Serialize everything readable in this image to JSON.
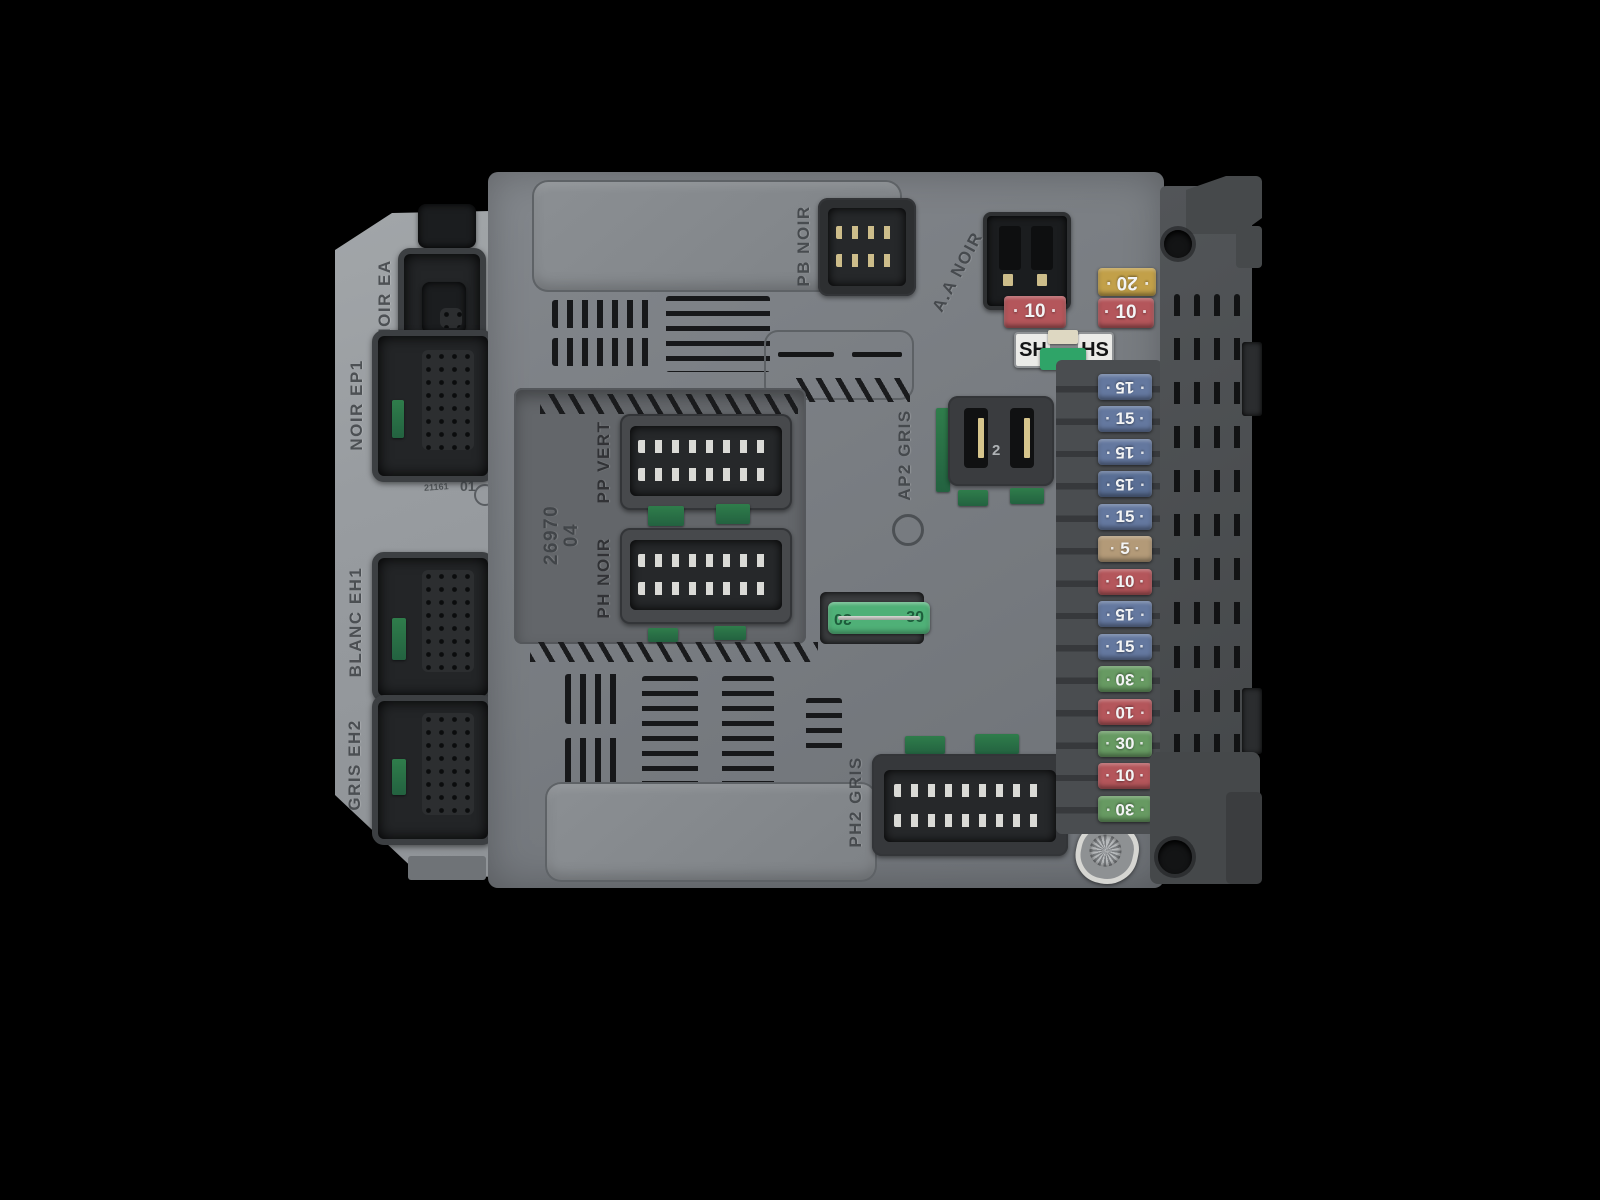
{
  "scene": {
    "description": "Gray automotive BSI body-control fuse box module photographed on a black background",
    "background_color": "#000000"
  },
  "left_module": {
    "connectors": [
      {
        "id": "noir-ea",
        "label": "NOIR EA"
      },
      {
        "id": "noir-ep1",
        "label": "NOIR EP1"
      },
      {
        "id": "blanc-eh1",
        "label": "BLANC EH1"
      },
      {
        "id": "gris-eh2",
        "label": "GRIS EH2"
      }
    ],
    "mold_marks": {
      "small_number": "21161",
      "cavity_number": "01"
    }
  },
  "center_body": {
    "labels": {
      "pb_noir": "PB NOIR",
      "aa_noir": "A.A NOIR",
      "pp_vert": "PP VERT",
      "ph_noir": "PH NOIR",
      "ap2_gris": "AP2 GRIS",
      "ph2_gris": "PH2 GRIS",
      "part_number": "26970",
      "part_suffix": "04",
      "ap2_cavity": "2"
    },
    "top_fuses": [
      {
        "value": "20",
        "color": "#c2a049",
        "reversed": true
      },
      {
        "value": "10",
        "color": "#b4565b",
        "reversed": false
      },
      {
        "value": "10",
        "color": "#b4565b",
        "reversed": false
      }
    ],
    "shunt_holder": {
      "left": "SH",
      "right": "HS",
      "puller_color": "#2fa468"
    },
    "maxi_fuse": {
      "value": "30",
      "color": "#4fb077"
    }
  },
  "fuse_strip": {
    "fuses": [
      {
        "value": "15",
        "color": "#64789f",
        "reversed": true
      },
      {
        "value": "15",
        "color": "#64789f",
        "reversed": false
      },
      {
        "value": "15",
        "color": "#64789f",
        "reversed": true
      },
      {
        "value": "15",
        "color": "#596e94",
        "reversed": true
      },
      {
        "value": "15",
        "color": "#64789f",
        "reversed": false
      },
      {
        "value": "5",
        "color": "#b39a78",
        "reversed": false
      },
      {
        "value": "10",
        "color": "#b4565b",
        "reversed": false
      },
      {
        "value": "15",
        "color": "#64789f",
        "reversed": true
      },
      {
        "value": "15",
        "color": "#64789f",
        "reversed": false
      },
      {
        "value": "30",
        "color": "#679a62",
        "reversed": true
      },
      {
        "value": "10",
        "color": "#b4565b",
        "reversed": true
      },
      {
        "value": "30",
        "color": "#679a62",
        "reversed": false
      },
      {
        "value": "10",
        "color": "#b4565b",
        "reversed": false
      },
      {
        "value": "30",
        "color": "#679a62",
        "reversed": true
      }
    ]
  }
}
